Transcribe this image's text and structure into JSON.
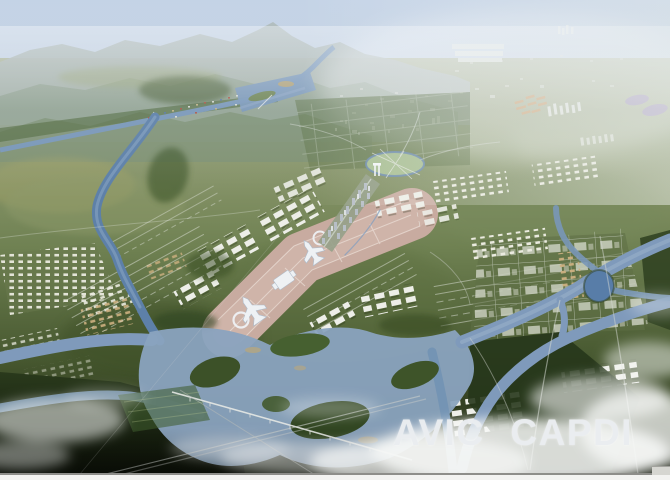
{
  "watermark": {
    "text": "AVIC CAPDI"
  },
  "scene": {
    "description": "Aerial perspective rendering of an airport-city master plan: braided rivers, farmland, mountains in haze, central runway/apron axis with terminals, surrounding building clusters and fog",
    "colors": {
      "sky": "#c3d2e6",
      "mountain_haze": "#9fae9f",
      "plain_green": "#76855c",
      "forest_dark": "#22301a",
      "river_blue": "#7b97b8",
      "apron_pink": "#c8aba0",
      "building_white": "#edeee8",
      "building_tan": "#cdb080",
      "building_purple": "#b2a5c6",
      "cloud_white": "#f6f7f6",
      "watermark_text": "#e9ecef",
      "border_gray": "#8e8e8a",
      "border_white": "#f3f3f1"
    }
  }
}
